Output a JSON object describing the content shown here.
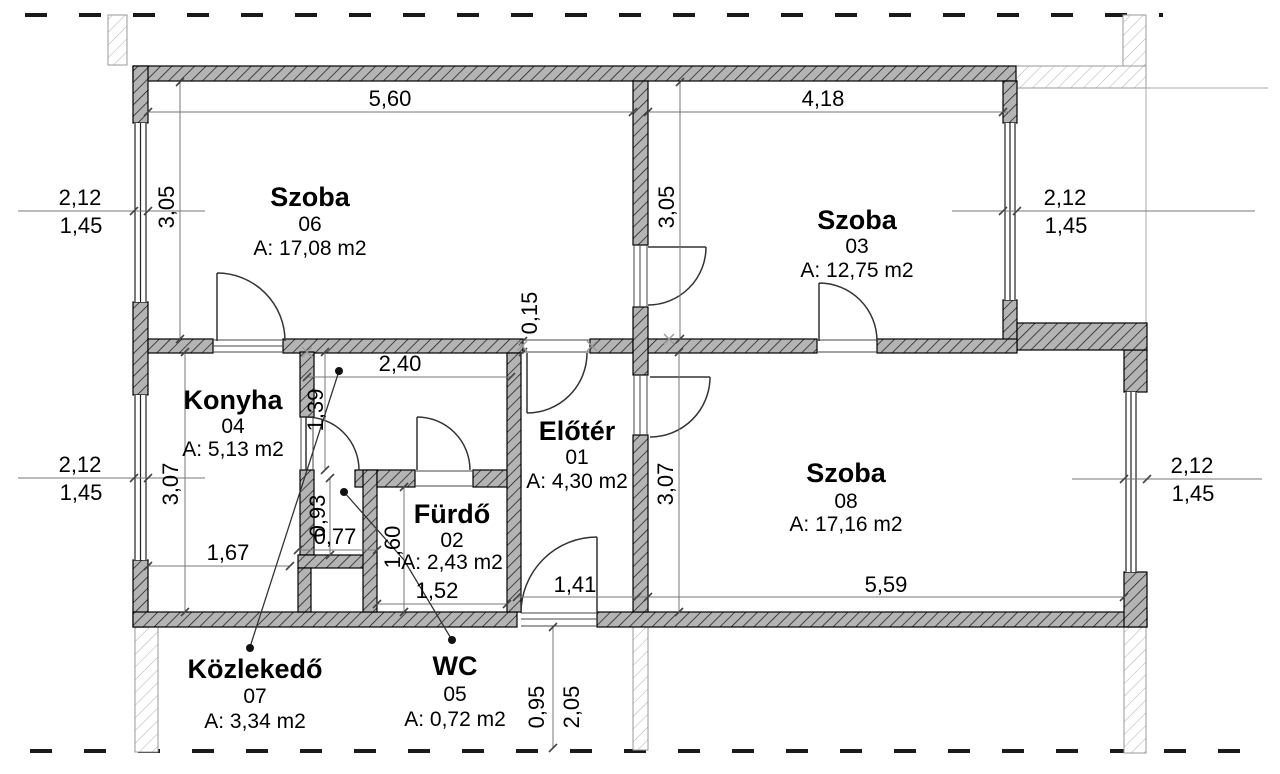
{
  "plan": {
    "title": "apartment-floor-plan",
    "rooms": [
      {
        "id": "szoba06",
        "name": "Szoba",
        "number": "06",
        "area": "A: 17,08 m2"
      },
      {
        "id": "szoba03",
        "name": "Szoba",
        "number": "03",
        "area": "A: 12,75 m2"
      },
      {
        "id": "szoba08",
        "name": "Szoba",
        "number": "08",
        "area": "A: 17,16 m2"
      },
      {
        "id": "konyha",
        "name": "Konyha",
        "number": "04",
        "area": "A: 5,13 m2"
      },
      {
        "id": "eloter",
        "name": "Előtér",
        "number": "01",
        "area": "A: 4,30 m2"
      },
      {
        "id": "furdo",
        "name": "Fürdő",
        "number": "02",
        "area": "A: 2,43 m2"
      },
      {
        "id": "kozlekedo",
        "name": "Közlekedő",
        "number": "07",
        "area": "A: 3,34 m2"
      },
      {
        "id": "wc",
        "name": "WC",
        "number": "05",
        "area": "A: 0,72 m2"
      }
    ],
    "dimensions": {
      "szoba06_width": "5,60",
      "szoba03_width": "4,18",
      "szoba06_depth": "3,05",
      "szoba03_depth": "3,05",
      "konyha_depth": "3,07",
      "szoba08_depth": "3,07",
      "wall_thickness": "0,15",
      "kozlekedo_width": "2,40",
      "kozlekedo_depth": "1,39",
      "wc_depth": "0,93",
      "wc_width": "0,77",
      "konyha_width": "1,67",
      "furdo_depth": "1,60",
      "furdo_width": "1,52",
      "entrance_width": "1,41",
      "szoba08_width": "5,59",
      "entrance_dim_a": "0,95",
      "entrance_dim_b": "2,05",
      "window_nw_width": "2,12",
      "window_nw_parapet": "1,45",
      "window_sw_width": "2,12",
      "window_sw_parapet": "1,45",
      "window_ne_width": "2,12",
      "window_ne_parapet": "1,45",
      "window_se_width": "2,12",
      "window_se_parapet": "1,45"
    },
    "colors": {
      "background": "#ffffff",
      "wall_fill": "#b4b4b4",
      "wall_hatch": "#111111",
      "neighbor_hatch": "#b0b0b0",
      "text": "#000000"
    }
  }
}
